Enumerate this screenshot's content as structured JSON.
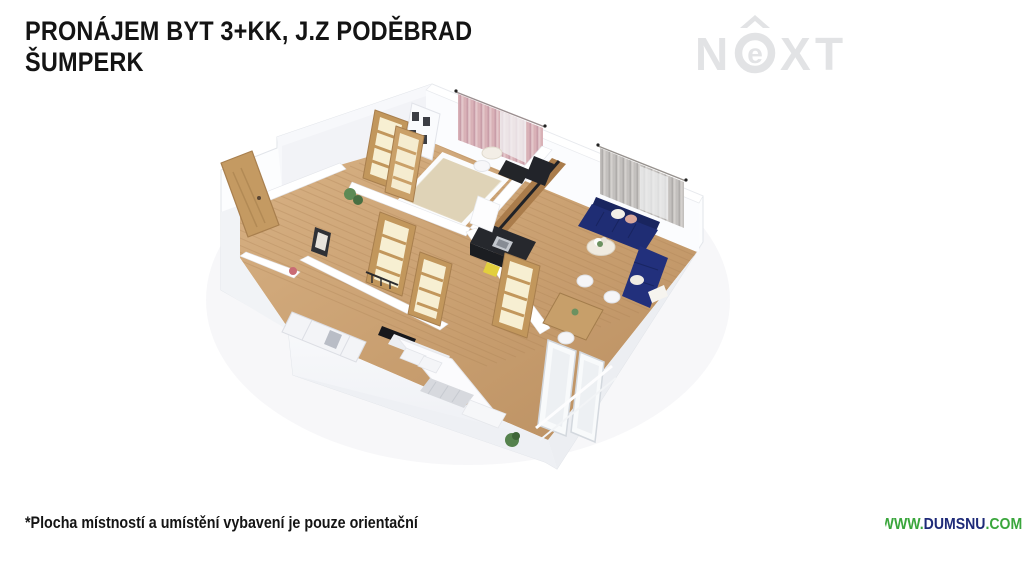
{
  "header": {
    "title_line1": "PRONÁJEM BYT 3+KK, J.Z PODĚBRAD",
    "title_line2": "ŠUMPERK"
  },
  "brand": {
    "name": "NEXT",
    "letter_n": "N",
    "letter_e": "e",
    "letter_x": "X",
    "letter_t": "T",
    "color": "#e2e3e5"
  },
  "footer": {
    "disclaimer": "*Plocha místností a umístění vybavení je pouze orientační",
    "website_prefix": "WWW.",
    "website_name": "DUMSNU",
    "website_suffix": ".COM",
    "website_green": "#3aa63c",
    "website_navy": "#1e2a78"
  },
  "floor_plan": {
    "kind": "3D dollhouse floor plan render, no text labels",
    "colors": {
      "floor_wood": "#c89e6f",
      "walls_white": "#f5f6f9",
      "sofa_navy": "#1f2d74",
      "curtain_pink": "#d8aeb4",
      "curtain_gray": "#b9b6b3",
      "door_oak": "#c2975e",
      "door_glass": "#f7efd2",
      "kitchen_black": "#24262b",
      "accent_yellow": "#e2cf3d",
      "plant_green": "#5d8a55",
      "bathroom_beige": "#e3d7bd"
    }
  }
}
